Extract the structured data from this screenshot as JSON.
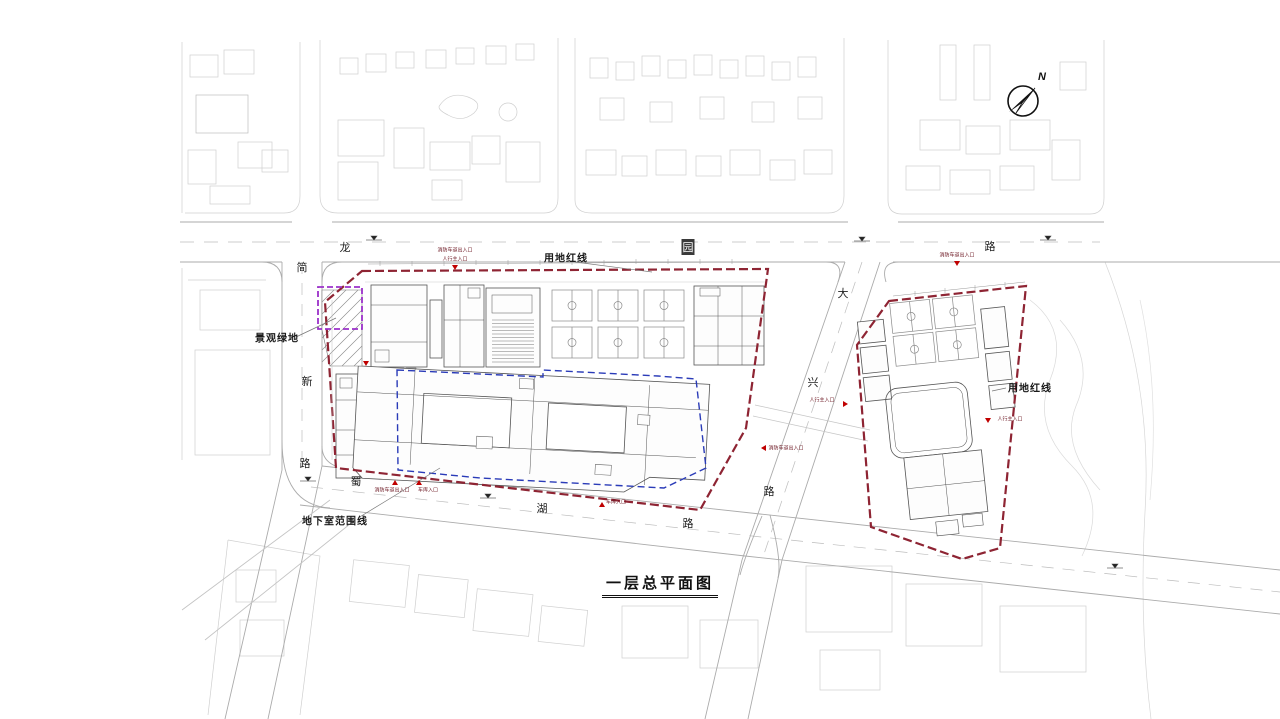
{
  "plan": {
    "title": "一层总平面图",
    "compass": {
      "north_label": "N"
    },
    "callouts": {
      "site_red_line_left": "用地红线",
      "site_red_line_right": "用地红线",
      "landscape_green": "景观绿地",
      "basement_extent": "地下室范围线"
    },
    "roads": {
      "top": {
        "name": "龙园路",
        "chars": [
          "龙",
          "园",
          "路"
        ]
      },
      "west": {
        "name": "简新路",
        "chars": [
          "简",
          "新",
          "路"
        ]
      },
      "south": {
        "name": "蜀湖路",
        "chars": [
          "蜀",
          "湖",
          "路"
        ]
      },
      "east": {
        "name": "大兴路",
        "chars": [
          "大",
          "兴",
          "路"
        ]
      }
    },
    "entrances": {
      "pedestrian_main": "人行主入口",
      "fire_access": "消防车道出入口",
      "garage": "车库入口"
    },
    "colors": {
      "boundary_red": "#8e2433",
      "basement_blue": "#2a3bb8",
      "green_purple": "#9b30c9",
      "marker_red": "#c00000"
    }
  }
}
